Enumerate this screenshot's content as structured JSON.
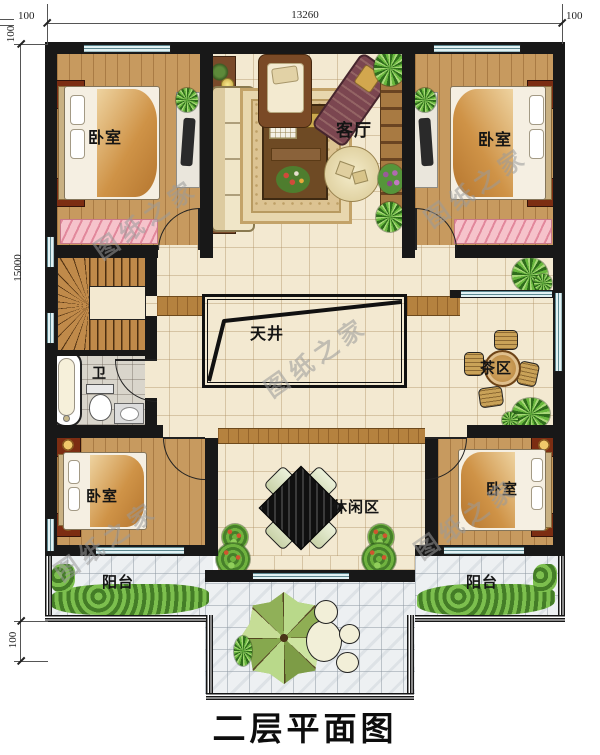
{
  "title": "二层平面图",
  "watermark": "图纸之家",
  "dimensions": {
    "top_width": "13260",
    "side_height": "15000",
    "offset_top_left": "100",
    "offset_top_right": "100",
    "offset_side_top": "100",
    "offset_side_bottom": "100"
  },
  "rooms": {
    "bedroom_top_left": "卧室",
    "bedroom_top_right": "卧室",
    "living_room": "客厅",
    "atrium": "天井",
    "tea_area": "茶区",
    "bathroom": "卫",
    "leisure_area": "休闲区",
    "bedroom_bottom_left": "卧室",
    "bedroom_bottom_right": "卧室",
    "balcony_left": "阳台",
    "balcony_right": "阳台"
  },
  "symbols": {
    "bed": "double-bed",
    "nightstand": "nightstand-with-lamp",
    "sofa": "sofa",
    "coffee_table": "coffee-table",
    "armchair": "armchair",
    "chaise": "chaise-lounge",
    "ottoman": "round-ottoman",
    "tv": "tv-cabinet",
    "stairs": "u-shaped-stair",
    "bathtub": "bathtub",
    "toilet": "toilet",
    "sink": "wash-basin",
    "tea_table": "round-table-with-chairs",
    "leisure_table": "diamond-table-with-chairs",
    "umbrella": "patio-umbrella",
    "stones": "stepping-stones",
    "plant": "potted-plant",
    "hedge": "shrub-hedge"
  },
  "colors": {
    "wall": "#181818",
    "window": "#e2f2f4",
    "wood_floor": "#c79a5f",
    "tile_floor": "#f3e9d1",
    "balcony_tile": "#edf0f2",
    "plant_green": "#4e8f2c",
    "bench_pink": "#f6c3cb"
  }
}
